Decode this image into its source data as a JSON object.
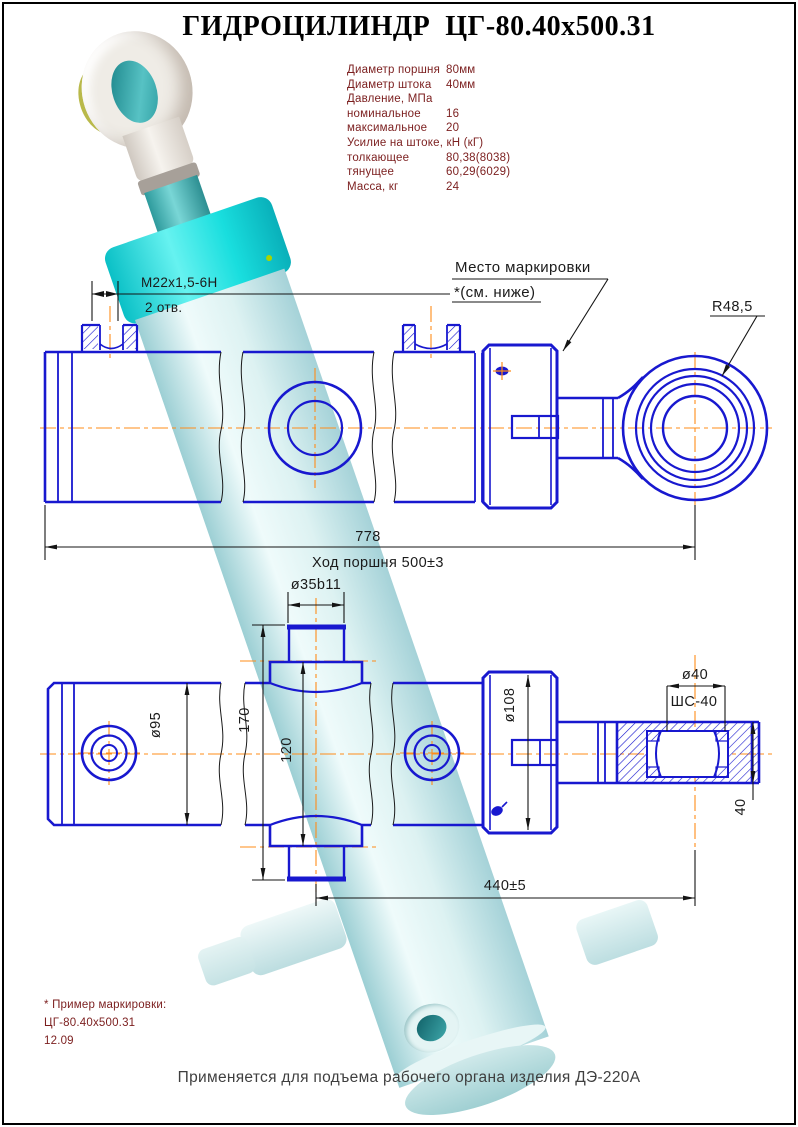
{
  "title": "ГИДРОЦИЛИНДР  ЦГ-80.40х500.31",
  "footer": "Применяется для подъема рабочего органа изделия ДЭ-220А",
  "specs": [
    {
      "label": "Диаметр поршня",
      "value": "80мм"
    },
    {
      "label": "Диаметр штока",
      "value": "40мм"
    },
    {
      "label": "Давление, МПа",
      "value": ""
    },
    {
      "label": "номинальное",
      "value": "16"
    },
    {
      "label": "максимальное",
      "value": "20"
    },
    {
      "label": "Усилие на штоке, кН (кГ)",
      "value": ""
    },
    {
      "label": "толкающее",
      "value": "80,38(8038)"
    },
    {
      "label": "тянущее",
      "value": "60,29(6029)"
    },
    {
      "label": "Масса, кг",
      "value": "24"
    }
  ],
  "callouts": {
    "thread": "M22x1,5-6H",
    "holes": "2 отв.",
    "marking_line1": "Место маркировки",
    "marking_line2": "*(см. ниже)",
    "radius": "R48,5"
  },
  "dims": {
    "overall": "778",
    "stroke": "Ход поршня 500±3",
    "trunnion_dia": "ø35b11",
    "cap_dia": "ø95",
    "trunnion_span": "170",
    "flats_span": "120",
    "head_dia": "ø108",
    "bearing_bore": "ø40",
    "bearing_type": "ШС-40",
    "rod_dia": "40",
    "axis_distance": "440±5"
  },
  "marking_note": {
    "line1": "* Пример маркировки:",
    "line2": "ЦГ-80.40х500.31",
    "line3": "12.09"
  },
  "colors": {
    "line_blue": "#1818cf",
    "centerline_orange": "#ff8c1a",
    "dim_black": "#1b1b1b",
    "spec_text_maroon": "#7b1e1e",
    "collar_cyan": "#19dede",
    "barrel_pale_cyan": "#ddf2f2"
  }
}
